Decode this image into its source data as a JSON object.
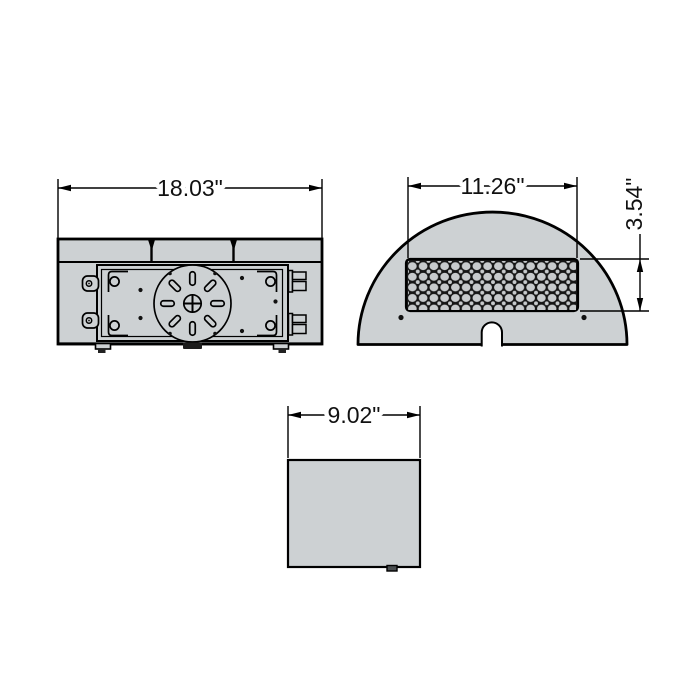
{
  "drawing": {
    "kind": "product dimension drawing",
    "views": {
      "back": {
        "width_dim": "18.03\""
      },
      "front": {
        "width_dim": "11.26\"",
        "lens_height_dim": "3.54\"",
        "led_rows": 5,
        "led_columns": 16
      },
      "bottom": {
        "width_dim": "9.02\""
      }
    },
    "colors": {
      "background": "#ffffff",
      "body_fill": "#cdd1d3",
      "line": "#000000",
      "lens_fill": "#161616",
      "led_dot": "#c7cacc"
    }
  }
}
